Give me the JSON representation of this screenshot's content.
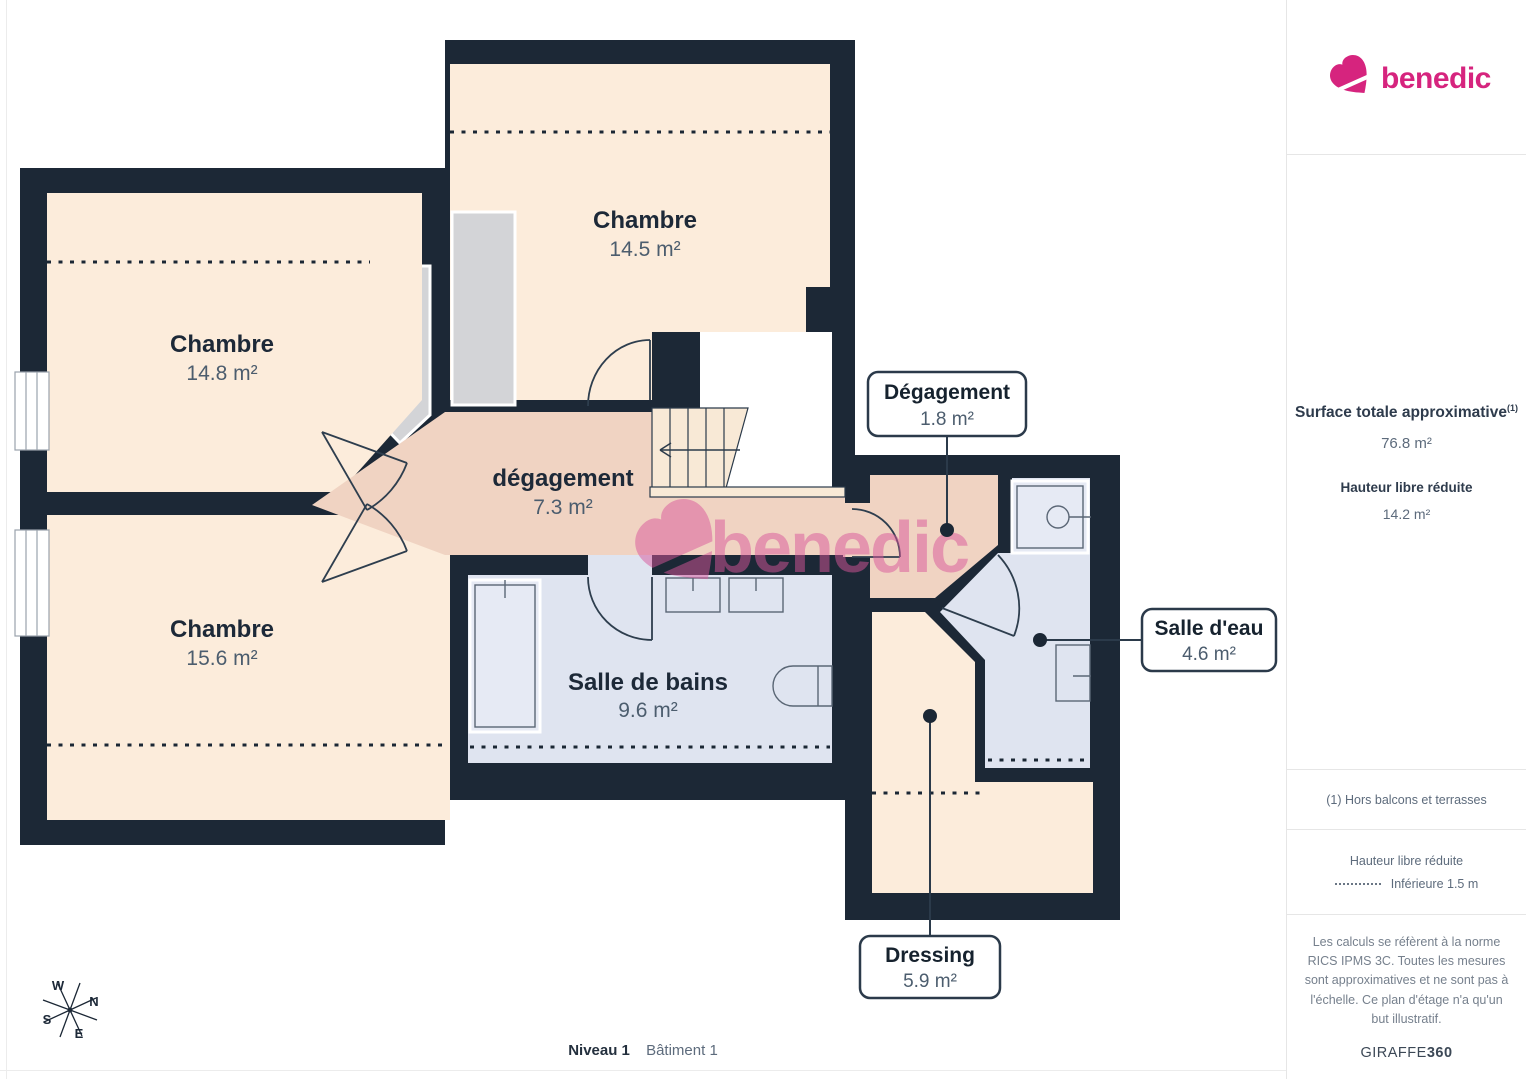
{
  "brand": {
    "name": "benedic",
    "color": "#d6247e"
  },
  "palette": {
    "wall": "#1c2836",
    "room": "#fcecdb",
    "hallway": "#f0d3c2",
    "wet": "#dfe4f0",
    "closet": "#d3d4d7",
    "watermark": "#d9569b"
  },
  "plan": {
    "rooms": {
      "chambre_top": {
        "name": "Chambre",
        "area": "14.5 m²"
      },
      "chambre_left": {
        "name": "Chambre",
        "area": "14.8 m²"
      },
      "chambre_bottom": {
        "name": "Chambre",
        "area": "15.6 m²"
      },
      "degagement": {
        "name": "dégagement",
        "area": "7.3 m²"
      },
      "salle_de_bains": {
        "name": "Salle de bains",
        "area": "9.6 m²"
      }
    },
    "callouts": {
      "degagement_small": {
        "name": "Dégagement",
        "area": "1.8 m²"
      },
      "salle_eau": {
        "name": "Salle d'eau",
        "area": "4.6 m²"
      },
      "dressing": {
        "name": "Dressing",
        "area": "5.9 m²"
      }
    },
    "compass": {
      "n": "N",
      "e": "E",
      "s": "S",
      "w": "W"
    }
  },
  "sidebar": {
    "surface_title": "Surface totale approximative",
    "surface_footnote_marker": "(1)",
    "surface_value": "76.8 m²",
    "reduced_height_title": "Hauteur libre réduite",
    "reduced_height_value": "14.2 m²",
    "footnote": "(1) Hors balcons et terrasses",
    "legend_title": "Hauteur libre réduite",
    "legend_item": "Inférieure 1.5 m",
    "disclaimer": "Les calculs se réfèrent à la norme RICS IPMS 3C. Toutes les mesures sont approximatives et ne sont pas à l'échelle. Ce plan d'étage n'a qu'un but illustratif.",
    "provider_name": "GIRAFFE",
    "provider_suffix": "360"
  },
  "footer": {
    "level": "Niveau 1",
    "building": "Bâtiment 1"
  }
}
